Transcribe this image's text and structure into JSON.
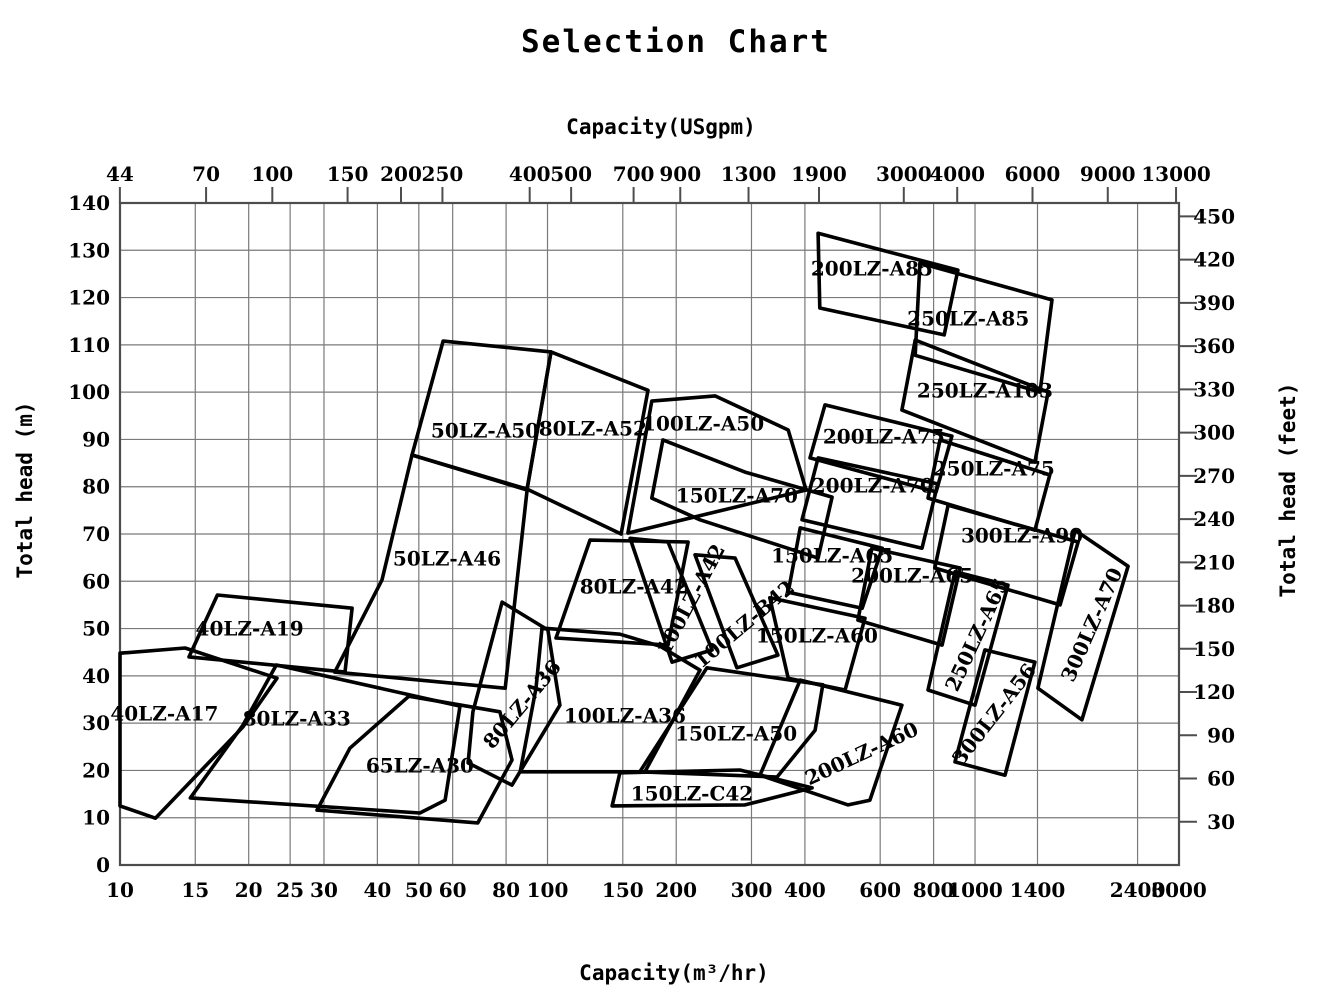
{
  "title": "Selection Chart",
  "colors": {
    "background": "#ffffff",
    "region_stroke": "#000000",
    "grid": "#7a7a7a",
    "frame": "#4d4d4d",
    "text": "#000000"
  },
  "chart_data": {
    "type": "area",
    "subtype": "pump-selection-chart-regions",
    "title": "Selection Chart",
    "grid": "on",
    "x_scale": "log",
    "x_axis_bottom": {
      "label": "Capacity(m³/hr)",
      "unit": "m3/hr",
      "range": [
        10,
        3000
      ],
      "ticks": [
        10,
        15,
        20,
        25,
        30,
        40,
        50,
        60,
        80,
        100,
        150,
        200,
        300,
        400,
        600,
        800,
        1000,
        1400,
        2400,
        3000
      ]
    },
    "x_axis_top": {
      "label": "Capacity(USgpm)",
      "unit": "USgpm",
      "usgpm_per_m3hr": 4.40287,
      "ticks": [
        44,
        70,
        100,
        150,
        200,
        250,
        400,
        500,
        700,
        900,
        1300,
        1900,
        3000,
        4000,
        6000,
        9000,
        13000
      ]
    },
    "y_axis_left": {
      "label": "Total head (m)",
      "unit": "m",
      "range": [
        0,
        140
      ],
      "ticks": [
        0,
        10,
        20,
        30,
        40,
        50,
        60,
        70,
        80,
        90,
        100,
        110,
        120,
        130,
        140
      ]
    },
    "y_axis_right": {
      "label": "Total head (feet)",
      "unit": "feet",
      "m_per_foot": 0.3048,
      "ticks": [
        30,
        60,
        90,
        120,
        150,
        180,
        210,
        240,
        270,
        300,
        330,
        360,
        390,
        420,
        450
      ]
    },
    "regions": [
      {
        "name": "40LZ-A17",
        "label_pos": [
          12.7,
          31.7
        ],
        "label_rotation": 0,
        "polygon": [
          [
            10,
            44.8
          ],
          [
            14.2,
            45.9
          ],
          [
            23.3,
            39.5
          ],
          [
            19.4,
            29.2
          ],
          [
            12.1,
            9.9
          ],
          [
            10,
            12.5
          ]
        ]
      },
      {
        "name": "40LZ-A19",
        "label_pos": [
          20.1,
          49.7
        ],
        "label_rotation": 0,
        "polygon": [
          [
            16.9,
            57.1
          ],
          [
            34.9,
            54.3
          ],
          [
            33.6,
            40.8
          ],
          [
            14.5,
            44.0
          ]
        ]
      },
      {
        "name": "80LZ-A33",
        "label_pos": [
          25.9,
          30.7
        ],
        "label_rotation": 0,
        "polygon": [
          [
            23.2,
            42.3
          ],
          [
            62.4,
            33.6
          ],
          [
            57.6,
            13.7
          ],
          [
            50.3,
            11.0
          ],
          [
            14.6,
            14.2
          ],
          [
            19.4,
            29.6
          ]
        ]
      },
      {
        "name": "65LZ-A30",
        "label_pos": [
          50.3,
          20.7
        ],
        "label_rotation": 0,
        "polygon": [
          [
            47.4,
            35.7
          ],
          [
            77.4,
            32.4
          ],
          [
            82.6,
            22.2
          ],
          [
            68.7,
            8.9
          ],
          [
            28.9,
            11.6
          ],
          [
            34.5,
            24.7
          ]
        ]
      },
      {
        "name": "50LZ-A46",
        "label_pos": [
          58.2,
          64.5
        ],
        "label_rotation": 0,
        "polygon": [
          [
            48.2,
            86.7
          ],
          [
            89.6,
            79.3
          ],
          [
            79.6,
            37.4
          ],
          [
            31.8,
            40.8
          ],
          [
            41.0,
            60.3
          ]
        ]
      },
      {
        "name": "50LZ-A50",
        "label_pos": [
          71.4,
          91.6
        ],
        "label_rotation": 0,
        "polygon": [
          [
            57.0,
            110.8
          ],
          [
            101.9,
            108.5
          ],
          [
            89.6,
            79.5
          ],
          [
            48.2,
            86.7
          ]
        ]
      },
      {
        "name": "80LZ-A36",
        "label_pos": [
          87.7,
          33.8
        ],
        "label_rotation": -50,
        "polygon": [
          [
            78.3,
            55.6
          ],
          [
            100.2,
            49.7
          ],
          [
            106.9,
            33.8
          ],
          [
            82.6,
            16.9
          ],
          [
            65.2,
            21.6
          ],
          [
            66.9,
            32.4
          ]
        ]
      },
      {
        "name": "80LZ-A52",
        "label_pos": [
          127.6,
          92.0
        ],
        "label_rotation": 0,
        "polygon": [
          [
            101.9,
            108.5
          ],
          [
            171.8,
            100.4
          ],
          [
            148.6,
            70.0
          ],
          [
            89.6,
            79.5
          ]
        ]
      },
      {
        "name": "80LZ-A42",
        "label_pos": [
          159.2,
          58.6
        ],
        "label_rotation": 0,
        "polygon": [
          [
            125.7,
            68.7
          ],
          [
            213.2,
            68.3
          ],
          [
            191.4,
            46.5
          ],
          [
            104.7,
            48.0
          ]
        ]
      },
      {
        "name": "100LZ-A36",
        "label_pos": [
          151.7,
          31.3
        ],
        "label_rotation": 0,
        "polygon": [
          [
            97.1,
            50.1
          ],
          [
            147.7,
            48.8
          ],
          [
            183.2,
            46.3
          ],
          [
            227.4,
            41.2
          ],
          [
            169.0,
            19.7
          ],
          [
            86.3,
            19.7
          ],
          [
            94.0,
            37.4
          ]
        ]
      },
      {
        "name": "100LZ-A50",
        "label_pos": [
          231.2,
          93.0
        ],
        "label_rotation": 0,
        "polygon": [
          [
            175.4,
            98.1
          ],
          [
            246.6,
            99.2
          ],
          [
            365.6,
            92.0
          ],
          [
            402.7,
            79.3
          ],
          [
            154.2,
            70.2
          ]
        ]
      },
      {
        "name": "100LZ-A42",
        "label_pos": [
          217.8,
          56.0
        ],
        "label_rotation": -62,
        "polygon": [
          [
            156.0,
            69.1
          ],
          [
            191.4,
            68.3
          ],
          [
            242.7,
            45.5
          ],
          [
            195.5,
            42.9
          ]
        ]
      },
      {
        "name": "100LZ-B42",
        "label_pos": [
          289.7,
          50.7
        ],
        "label_rotation": -40,
        "polygon": [
          [
            221.3,
            65.6
          ],
          [
            274.6,
            64.9
          ],
          [
            345.9,
            44.4
          ],
          [
            277.4,
            41.7
          ]
        ]
      },
      {
        "name": "150LZ-A70",
        "label_pos": [
          277.4,
          77.8
        ],
        "label_rotation": 0,
        "polygon": [
          [
            186.2,
            89.9
          ],
          [
            289.7,
            83.1
          ],
          [
            463.1,
            77.8
          ],
          [
            429.5,
            64.9
          ],
          [
            227.4,
            73.0
          ],
          [
            175.4,
            77.6
          ]
        ]
      },
      {
        "name": "150LZ-C42",
        "label_pos": [
          217.8,
          14.8
        ],
        "label_rotation": 0,
        "polygon": [
          [
            147.7,
            19.5
          ],
          [
            281.8,
            20.1
          ],
          [
            415.9,
            16.3
          ],
          [
            289.7,
            12.7
          ],
          [
            141.6,
            12.5
          ]
        ]
      },
      {
        "name": "150LZ-A50",
        "label_pos": [
          276.1,
          27.5
        ],
        "label_rotation": 0,
        "polygon": [
          [
            236.0,
            41.7
          ],
          [
            440.6,
            38.1
          ],
          [
            422.7,
            28.5
          ],
          [
            344.3,
            18.6
          ],
          [
            164.4,
            19.7
          ]
        ]
      },
      {
        "name": "150LZ-A60",
        "label_pos": [
          426.6,
          48.2
        ],
        "label_rotation": 0,
        "polygon": [
          [
            331.1,
            56.5
          ],
          [
            553.0,
            52.2
          ],
          [
            496.6,
            37.0
          ],
          [
            365.6,
            39.5
          ]
        ]
      },
      {
        "name": "150LZ-A65",
        "label_pos": [
          463.1,
          65.1
        ],
        "label_rotation": 0,
        "polygon": [
          [
            390.1,
            71.3
          ],
          [
            606.7,
            67.0
          ],
          [
            544.5,
            54.3
          ],
          [
            365.6,
            57.7
          ]
        ]
      },
      {
        "name": "200LZ-A60",
        "label_pos": [
          544.5,
          23.3
        ],
        "label_rotation": -25,
        "polygon": [
          [
            390.1,
            39.1
          ],
          [
            674.5,
            33.8
          ],
          [
            567.6,
            13.7
          ],
          [
            504.7,
            12.7
          ],
          [
            314.1,
            19.0
          ]
        ]
      },
      {
        "name": "200LZ-A65",
        "label_pos": [
          712.8,
          60.9
        ],
        "label_rotation": 0,
        "polygon": [
          [
            573.9,
            67.0
          ],
          [
            922.6,
            62.8
          ],
          [
            837.5,
            46.5
          ],
          [
            532.1,
            51.8
          ]
        ]
      },
      {
        "name": "200LZ-A70",
        "label_pos": [
          576.6,
          79.9
        ],
        "label_rotation": 0,
        "polygon": [
          [
            429.5,
            86.1
          ],
          [
            818.5,
            80.6
          ],
          [
            751.6,
            67.0
          ],
          [
            393.7,
            73.0
          ]
        ]
      },
      {
        "name": "200LZ-A75",
        "label_pos": [
          612.3,
          90.3
        ],
        "label_rotation": 0,
        "polygon": [
          [
            445.7,
            97.3
          ],
          [
            883.1,
            90.7
          ],
          [
            811.0,
            78.9
          ],
          [
            411.2,
            86.1
          ]
        ]
      },
      {
        "name": "200LZ-A85",
        "label_pos": [
          573.9,
          125.8
        ],
        "label_rotation": 0,
        "polygon": [
          [
            429.5,
            133.6
          ],
          [
            912.0,
            125.8
          ],
          [
            847.2,
            112.1
          ],
          [
            433.5,
            117.8
          ]
        ]
      },
      {
        "name": "250LZ-A85",
        "label_pos": [
          964.0,
          115.3
        ],
        "label_rotation": 0,
        "polygon": [
          [
            743.0,
            127.3
          ],
          [
            1513.6,
            119.5
          ],
          [
            1419.1,
            100.0
          ],
          [
            724.4,
            107.8
          ]
        ]
      },
      {
        "name": "250LZ-A103",
        "label_pos": [
          1054.4,
          100.0
        ],
        "label_rotation": 0,
        "polygon": [
          [
            724.4,
            111.0
          ],
          [
            1482.3,
            100.0
          ],
          [
            1380.4,
            85.2
          ],
          [
            674.5,
            96.2
          ]
        ]
      },
      {
        "name": "250LZ-A75",
        "label_pos": [
          1106.6,
          83.5
        ],
        "label_rotation": 0,
        "polygon": [
          [
            827.9,
            89.9
          ],
          [
            1496.2,
            82.5
          ],
          [
            1380.4,
            70.8
          ],
          [
            776.2,
            77.6
          ]
        ]
      },
      {
        "name": "250LZ-A65",
        "label_pos": [
          1016.2,
          48.6
        ],
        "label_rotation": -65,
        "polygon": [
          [
            897.6,
            62.0
          ],
          [
            1194.3,
            59.2
          ],
          [
            1000.0,
            33.8
          ],
          [
            776.2,
            37.0
          ]
        ]
      },
      {
        "name": "300LZ-A90",
        "label_pos": [
          1288.2,
          69.4
        ],
        "label_rotation": 0,
        "polygon": [
          [
            864.9,
            76.1
          ],
          [
            1742.3,
            68.3
          ],
          [
            1581.2,
            55.0
          ],
          [
            805.4,
            62.8
          ]
        ]
      },
      {
        "name": "300LZ-A56",
        "label_pos": [
          1114.3,
          31.7
        ],
        "label_rotation": -52,
        "polygon": [
          [
            1054.4,
            45.5
          ],
          [
            1380.4,
            42.9
          ],
          [
            1174.9,
            19.0
          ],
          [
            897.6,
            21.8
          ]
        ]
      },
      {
        "name": "300LZ-A70",
        "label_pos": [
          1888.0,
          50.7
        ],
        "label_rotation": -66,
        "polygon": [
          [
            1714.3,
            70.8
          ],
          [
            2280.6,
            63.2
          ],
          [
            1778.3,
            30.7
          ],
          [
            1403.1,
            37.4
          ]
        ]
      }
    ]
  }
}
